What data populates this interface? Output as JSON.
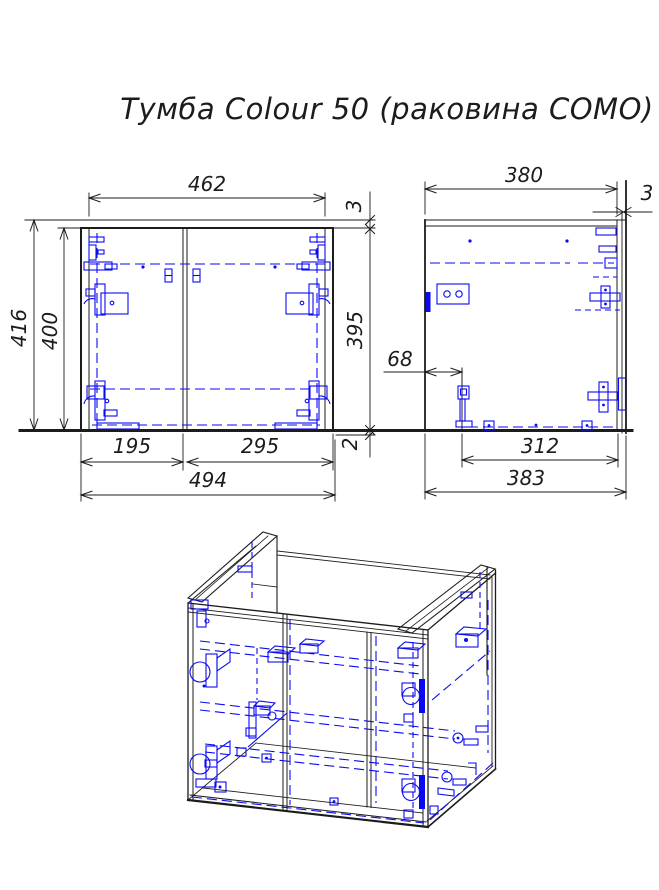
{
  "title": "Тумба Colour 50 (раковина COMO)",
  "colors": {
    "line": "#1c1c1c",
    "hardware": "#0a0af2",
    "paper": "#ffffff"
  },
  "dimensions": {
    "front": {
      "top_panel_width": "462",
      "overall_height": "416",
      "carcass_height": "400",
      "top_gap": "3",
      "opening_height": "395",
      "bottom_gap": "2",
      "left_door_width": "195",
      "right_door_width": "295",
      "overall_width": "494"
    },
    "side": {
      "top_depth": "380",
      "back_panel_thickness": "3",
      "bottom_recess": "68",
      "bottom_depth": "312",
      "overall_depth": "383"
    }
  }
}
